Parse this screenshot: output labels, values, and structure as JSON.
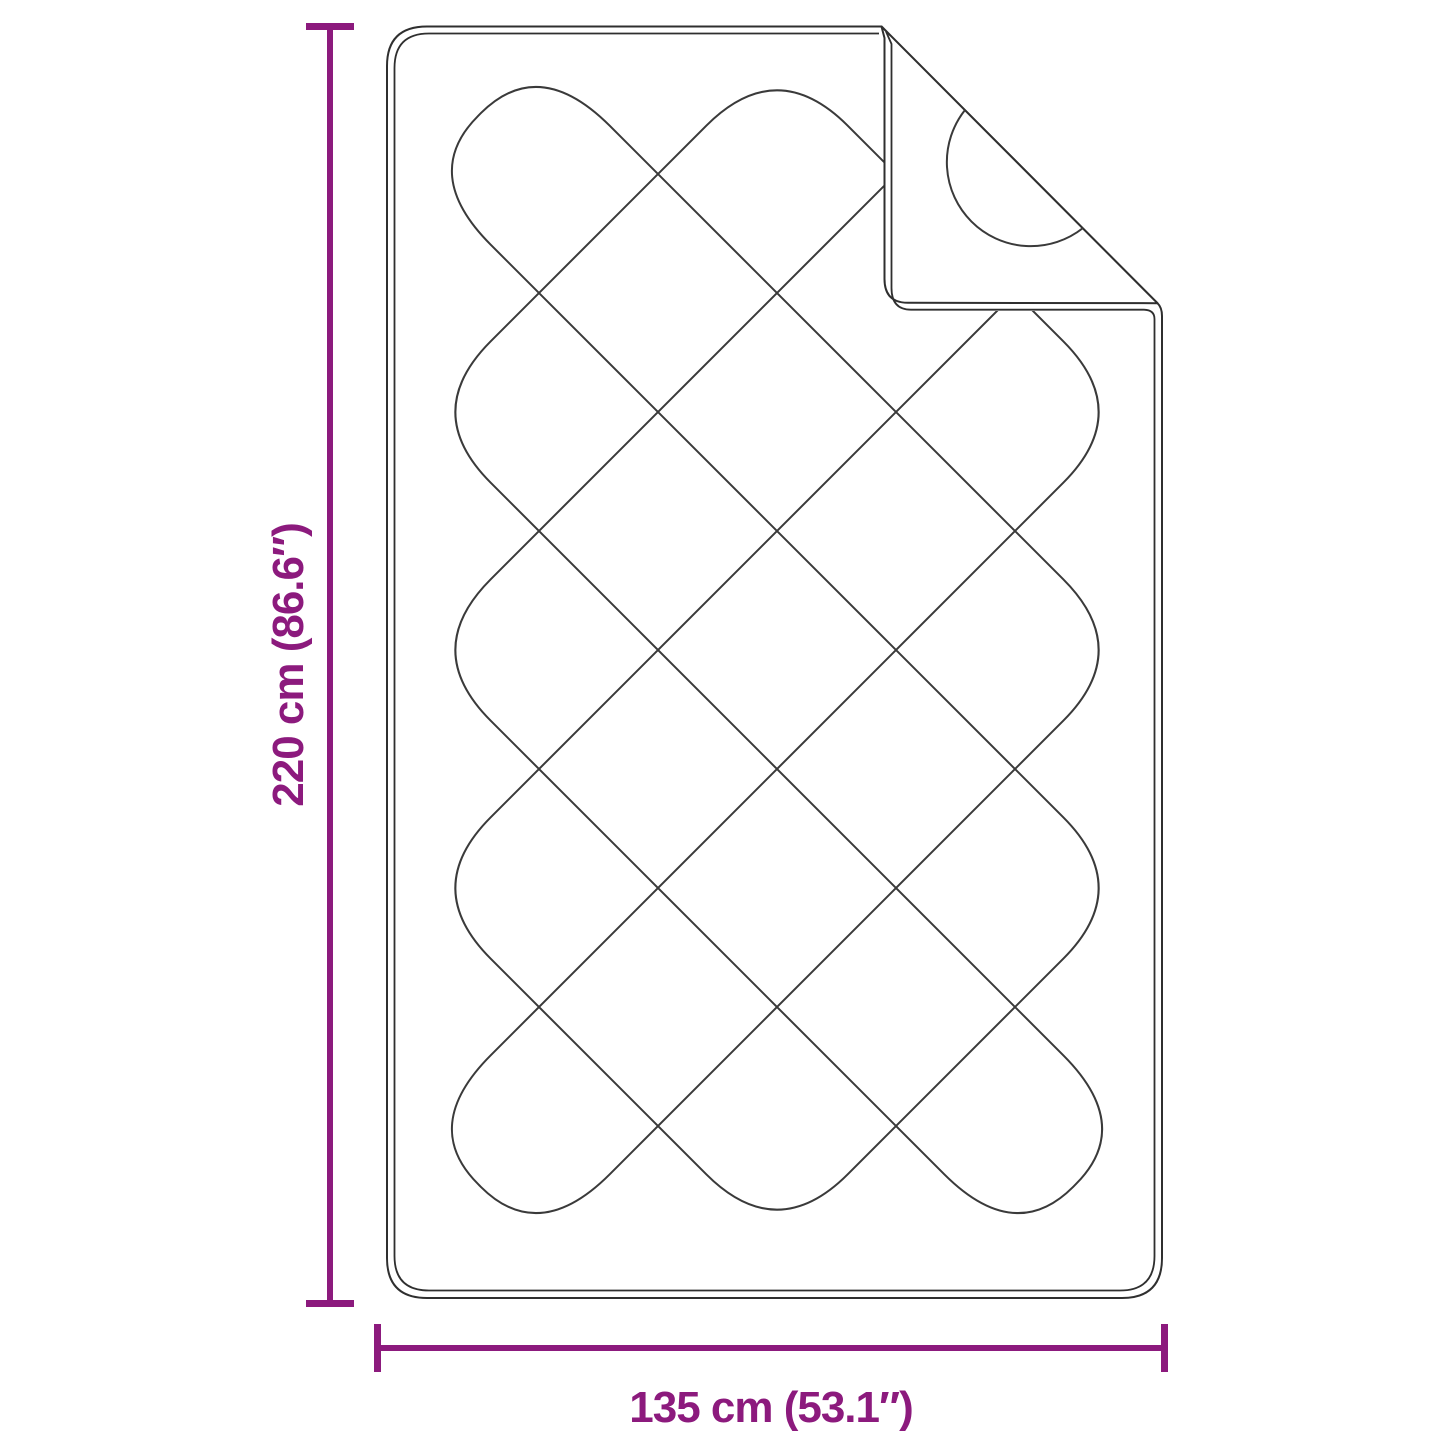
{
  "diagram": {
    "type": "product-dimension-diagram",
    "subject": "quilted blanket with folded corner",
    "height_label": "220 cm (86.6″)",
    "width_label": "135 cm (53.1″)",
    "colors": {
      "dimension": "#8C1A7D",
      "outline": "#2f2f2f",
      "quilting": "#3a3a3a",
      "background": "#ffffff"
    }
  }
}
